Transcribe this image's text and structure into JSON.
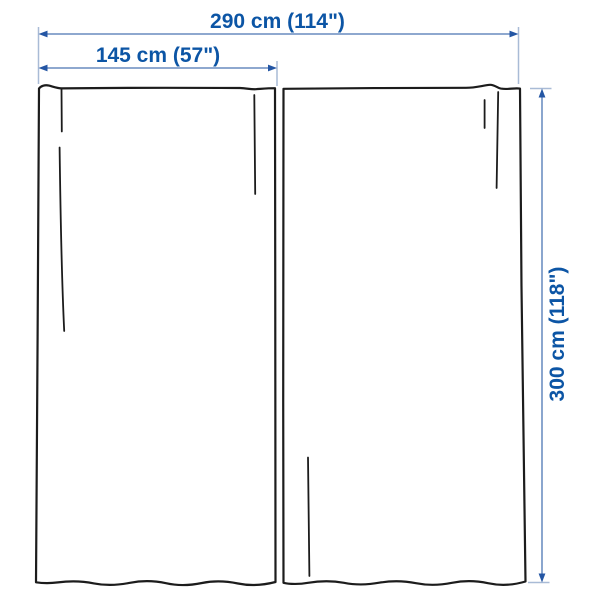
{
  "diagram": {
    "subject": "curtains-two-panels-dimension-drawing",
    "dimensions": {
      "total_width_label": "290 cm (114\")",
      "panel_width_label": "145 cm (57\")",
      "height_label": "300 cm (118\")"
    },
    "colors": {
      "label_text": "#0c55a5",
      "dimension_line": "#7e9cc8",
      "extension_line": "#a9bbd6",
      "arrowhead": "#2456a4",
      "curtain_outline": "#1c1c1c",
      "background": "#ffffff"
    }
  }
}
